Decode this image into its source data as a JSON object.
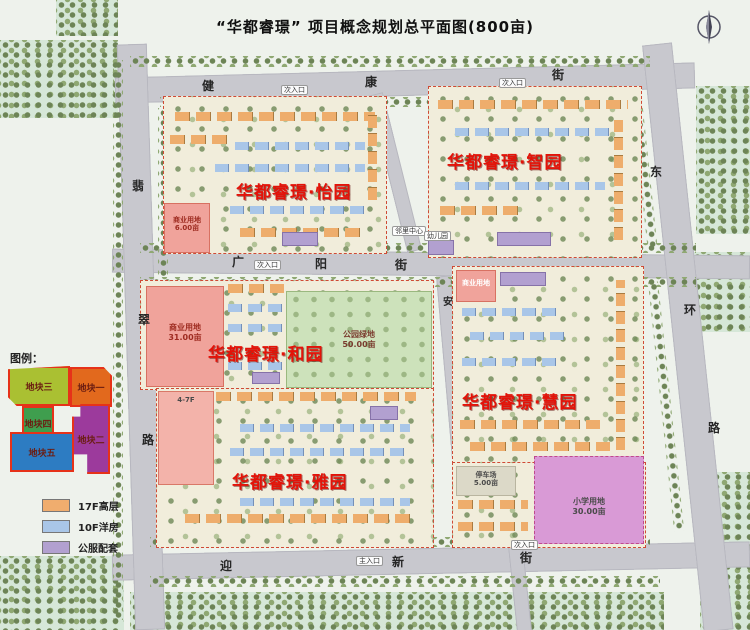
{
  "title": "“华都睿璟” 项目概念规划总平面图(800亩)",
  "icons": {
    "compass": "north-arrow"
  },
  "plan": {
    "districts": [
      {
        "name": "华都睿璟·怡园"
      },
      {
        "name": "华都睿璟·智园"
      },
      {
        "name": "华都睿璟·和园"
      },
      {
        "name": "华都睿璟·慧园"
      },
      {
        "name": "华都睿璟·雅园"
      }
    ],
    "streets": {
      "top": {
        "name": "健康街",
        "chars": [
          "健",
          "康",
          "街"
        ]
      },
      "middle": {
        "name": "广阳街",
        "chars": [
          "广",
          "阳",
          "街"
        ]
      },
      "bottom": {
        "name": "迎新街",
        "chars": [
          "迎",
          "新",
          "街"
        ]
      },
      "left": {
        "name": "翡翠路",
        "chars": [
          "翡",
          "翠",
          "路"
        ]
      },
      "right": {
        "name": "东环路",
        "chars": [
          "东",
          "环",
          "路"
        ]
      },
      "inner": {
        "name": "安",
        "chars": [
          "安"
        ]
      }
    },
    "land_labels": {
      "commercial_yiyuan": {
        "text": "商业用地",
        "area": "6.00亩"
      },
      "commercial_heyuan": {
        "text": "商业用地",
        "area": "31.00亩"
      },
      "park": {
        "text": "公园绿地",
        "area": "50.00亩"
      },
      "commercial_huiyuan": {
        "text": "商业用地",
        "area": ""
      },
      "parking": {
        "text": "停车场",
        "area": "5.00亩"
      },
      "school": {
        "text": "小学用地",
        "area": "30.00亩"
      },
      "lowrise": {
        "text": "4-7F",
        "area": ""
      }
    },
    "facilities": [
      {
        "label": "邻里中心"
      },
      {
        "label": "幼儿园"
      }
    ],
    "entrances": [
      {
        "label": "次入口"
      },
      {
        "label": "次入口"
      },
      {
        "label": "次入口"
      },
      {
        "label": "主入口"
      },
      {
        "label": "次入口"
      }
    ]
  },
  "legend": {
    "title": "图例：",
    "plots": [
      {
        "label": "地块三",
        "color": "#aac032"
      },
      {
        "label": "地块一",
        "color": "#e2691d"
      },
      {
        "label": "地块四",
        "color": "#3f9e4e"
      },
      {
        "label": "地块二",
        "color": "#9c3a9c"
      },
      {
        "label": "地块五",
        "color": "#2d7cc2"
      }
    ],
    "building_types": [
      {
        "label": "17F高层",
        "color": "#f0ad6e"
      },
      {
        "label": "10F洋房",
        "color": "#a9c6e8"
      },
      {
        "label": "公服配套",
        "color": "#b2a0d0"
      }
    ]
  }
}
